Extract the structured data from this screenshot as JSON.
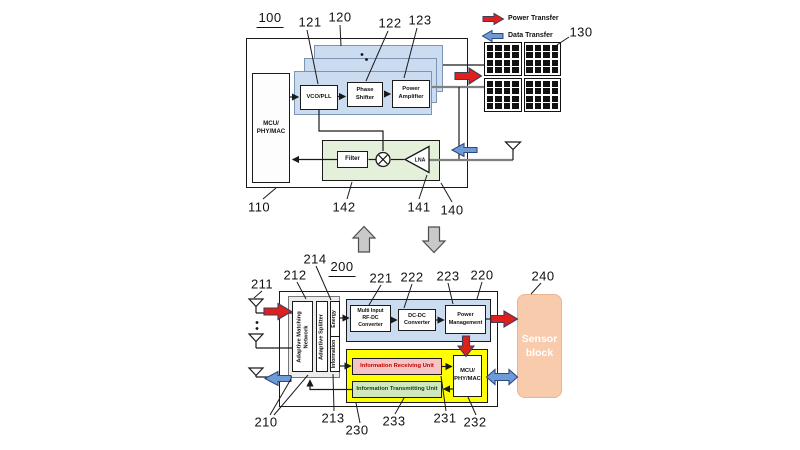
{
  "colors": {
    "ink": "#1a1a1a",
    "wire-gray": "#808080",
    "arrow-red": "#e0201c",
    "arrow-red-border": "#3d3d5c",
    "arrow-blue": "#6f9ad8",
    "arrow-blue-border": "#2d4a7a",
    "arrow-gray": "#c9c9c9",
    "arrow-gray-border": "#4d4d4d",
    "panel-blue": "#cbdcf0",
    "panel-blue-border": "#7d95b5",
    "region-green": "#e5f0da",
    "region-yellow": "#ffff00",
    "box-pink": "#f6c4c4",
    "box-pink-text": "#c00000",
    "box-green": "#cfe8bd",
    "box-green-text": "#1d3d14",
    "sensor-peach": "#f8cbad",
    "container-gray": "#ededed"
  },
  "legend": {
    "power_label": "Power Transfer",
    "data_label": "Data Transfer"
  },
  "d1": {
    "blocks": {
      "mcu": "MCU/\nPHY/MAC",
      "vco": "VCO/PLL",
      "phase": "Phase\nShifter",
      "pa": "Power\nAmplifier",
      "filter": "Filter",
      "lna": "LNA"
    },
    "labels": {
      "fig": "100",
      "mcu": "110",
      "panels": "120",
      "vco": "121",
      "phase": "122",
      "pa": "123",
      "array": "130",
      "rx_chain": "140",
      "lna": "141",
      "filter": "142"
    }
  },
  "d2": {
    "blocks": {
      "amn": "Adaptive Matching\nNetwork",
      "splitter": "Adaptive Splitter",
      "energy": "Energy",
      "information": "Information",
      "multi": "Multi Input\nRF-DC\nConverter",
      "dcdc": "DC-DC\nConverter",
      "pm": "Power\nManagement",
      "iru": "Information Receiving Unit",
      "itu": "Information Transmitting Unit",
      "mcu": "MCU/\nPHY/MAC",
      "sensor": "Sensor\nblock"
    },
    "labels": {
      "fig": "200",
      "module": "210",
      "antennas": "211",
      "amn": "212",
      "splitter": "213",
      "energy": "214",
      "power_region": "220",
      "multi": "221",
      "dcdc": "222",
      "pm": "223",
      "info_region": "230",
      "iru": "231",
      "mcu": "232",
      "itu": "233",
      "sensor": "240"
    }
  }
}
